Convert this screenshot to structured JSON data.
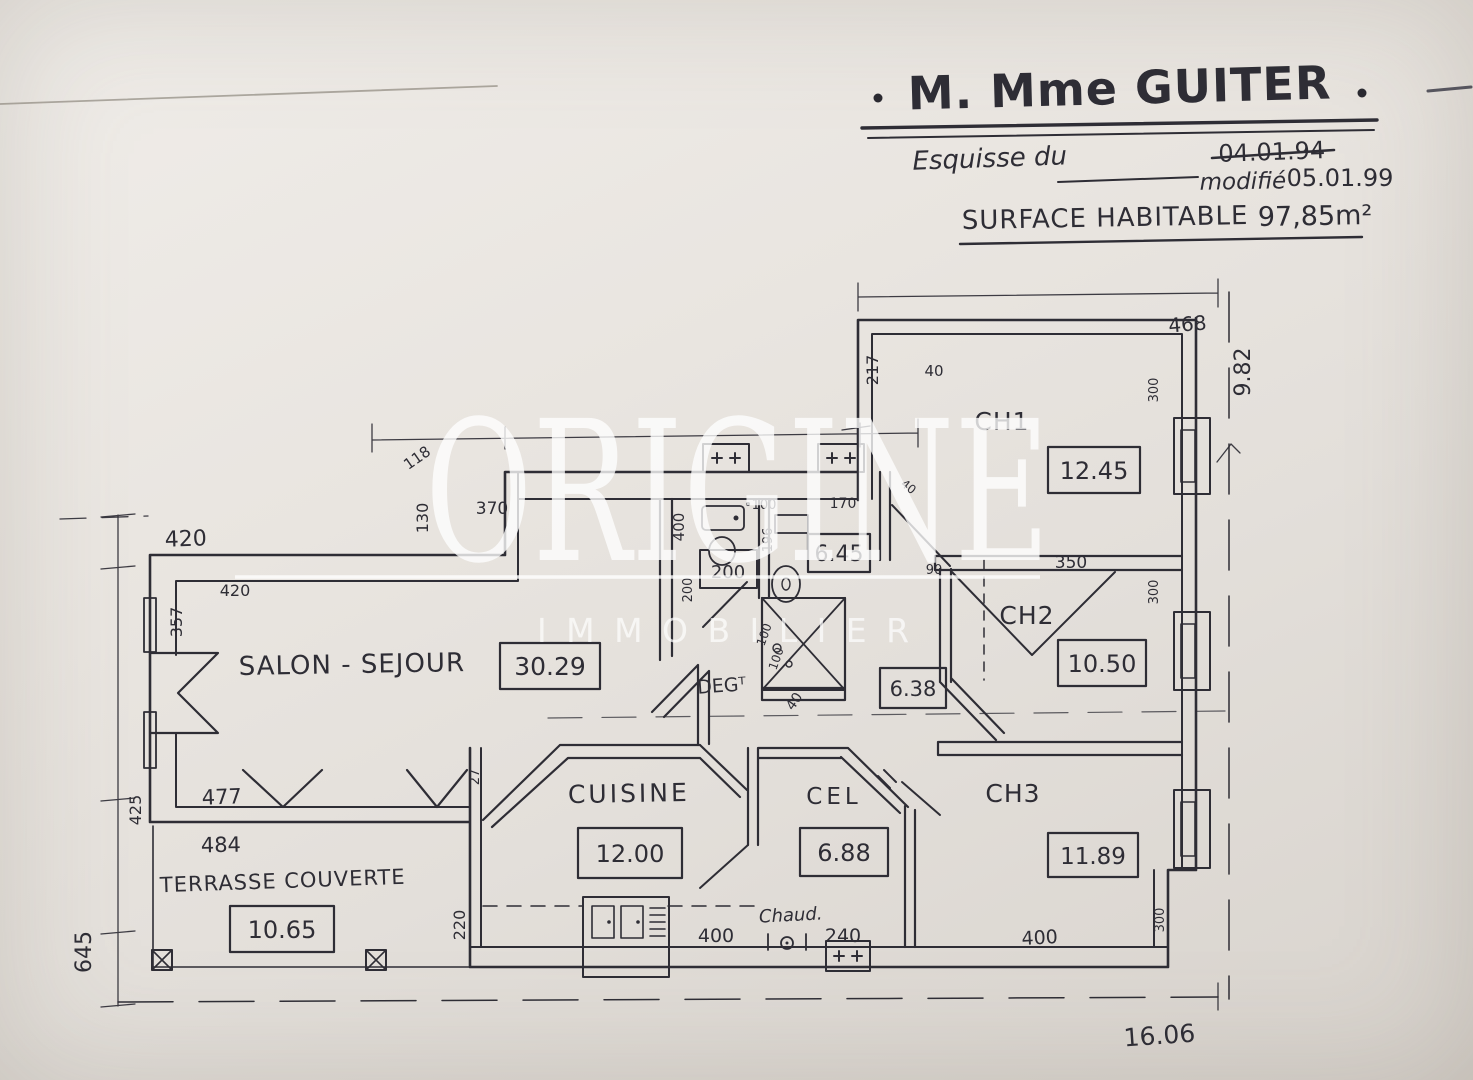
{
  "colors": {
    "paper": "#e8e4df",
    "ink": "#2e2d35",
    "watermark": "#ffffff"
  },
  "watermark": {
    "primary": "ORIGINE",
    "secondary": "IMMOBILIER"
  },
  "header": {
    "client_title": "M. Mme GUITER",
    "esquisse_label": "Esquisse du",
    "date_original": "04.01.94",
    "modified_label": "modifié",
    "date_modified": "05.01.99",
    "surface_label": "SURFACE HABITABLE",
    "surface_value": "97,85m²"
  },
  "rooms": {
    "salon": {
      "name": "SALON - SEJOUR",
      "area": "30.29"
    },
    "cuisine": {
      "name": "CUISINE",
      "area": "12.00"
    },
    "cellier": {
      "name": "CEL",
      "area": "6.88"
    },
    "ch1": {
      "name": "CH1",
      "area": "12.45"
    },
    "ch2": {
      "name": "CH2",
      "area": "10.50"
    },
    "ch3": {
      "name": "CH3",
      "area": "11.89"
    },
    "degagement": {
      "name": "DEGᵀ"
    },
    "salle_bain": {
      "area": "6.45"
    },
    "salle_eau": {
      "area": "6.38"
    },
    "terrasse": {
      "name": "TERRASSE COUVERTE",
      "area": "10.65"
    },
    "chaudiere": {
      "name": "Chaud."
    }
  },
  "dims": {
    "t420a": "420",
    "t420b": "420",
    "l357": "357",
    "s130": "130",
    "t370": "370",
    "d118": "118",
    "h400": "400",
    "wc100": "100",
    "b196": "196",
    "w170": "170",
    "c217": "217",
    "c40": "40",
    "d40": "40",
    "t468": "468",
    "r982": "9.82",
    "w300a": "300",
    "w300b": "300",
    "w300c": "300",
    "c350": "350",
    "h90": "90",
    "p200": "200",
    "p200v": "200",
    "s100a": "100",
    "s100b": "100",
    "h40": "40",
    "l425": "425",
    "l477": "477",
    "l484": "484",
    "w27": "27",
    "k220": "220",
    "k400": "400",
    "e240": "240",
    "c3400": "400",
    "l645": "645",
    "b1606": "16.06"
  }
}
